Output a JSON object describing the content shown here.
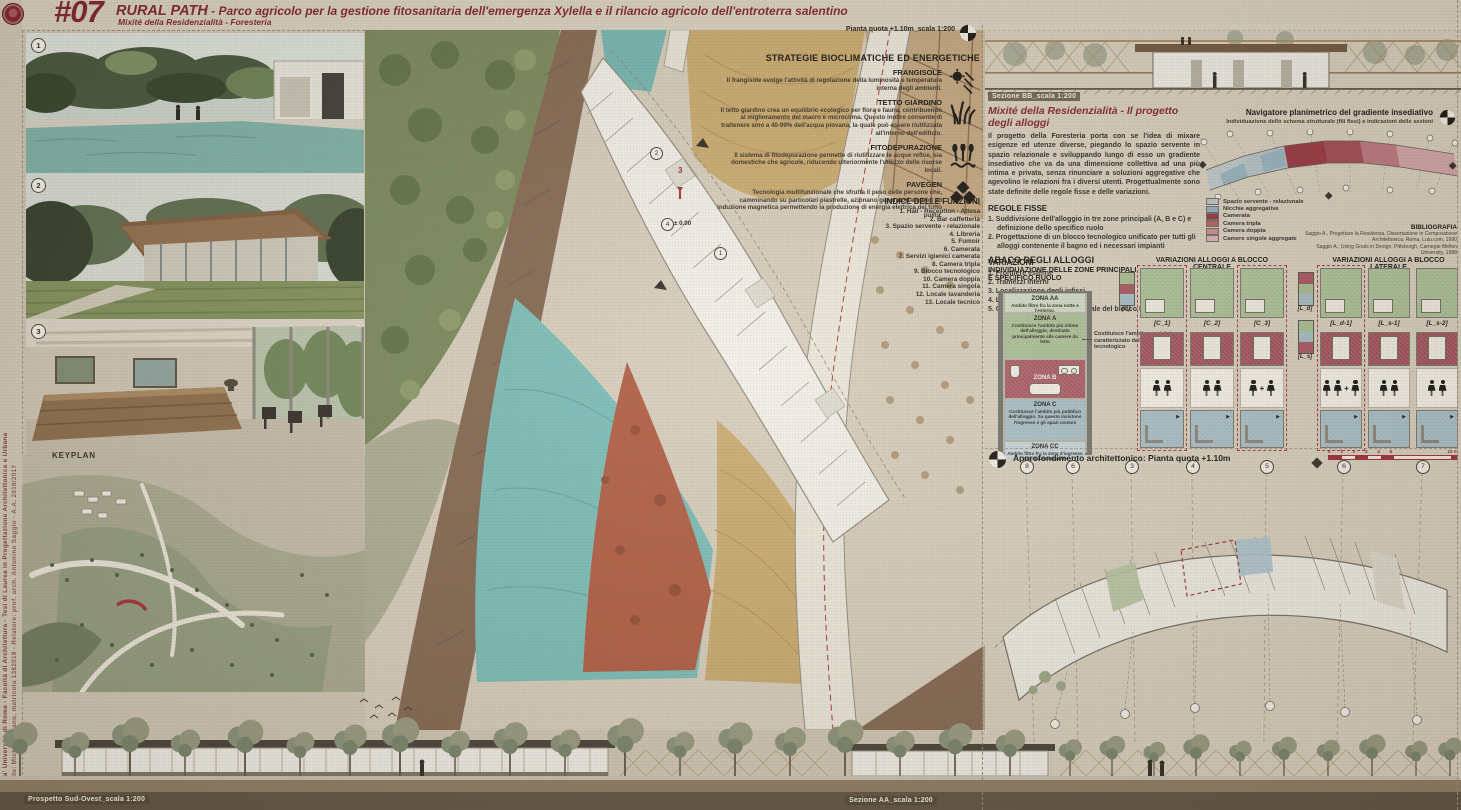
{
  "header": {
    "number": "#07",
    "title": "RURAL PATH",
    "subtitle": " - Parco agricolo per la gestione fitosanitaria dell'emergenza Xylella e il rilancio agricolo dell'entroterra salentino",
    "tagline": "Mixité della Residenzialità - Foresteria",
    "accent_color": "#7e1f2a",
    "logo": "sapienza-seal"
  },
  "side_caption": {
    "line1": "'Sapienza' Università di Roma - Facoltà di Architettura - Tesi di Laurea in Progettazione Architettonica e Urbana",
    "line2": "Laureando: Michele Spano, matricola 1382019 - Relatore: prof. arch. Antonino Saggio - A.A. 2016/2017"
  },
  "photos": {
    "badge1": "1",
    "badge2": "2",
    "badge3": "3"
  },
  "keyplan_label": "KEYPLAN",
  "masterplan": {
    "plan_scale_label": "Pianta quota +1.10m_scala 1:200",
    "level_marker": "± 0.00",
    "section_number": "3",
    "marker_2": "2",
    "marker_4": "4",
    "marker_1": "1"
  },
  "strategie": {
    "title": "STRATEGIE BIOCLIMATICHE ED ENERGETICHE",
    "items": [
      {
        "name": "FRANGISOLE",
        "icon": "sun-louvers-icon",
        "text": "Il frangisole svolge l'attività di regolazione della luminosità e temperatura interna degli ambienti."
      },
      {
        "name": "TETTO GIARDINO",
        "icon": "grass-icon",
        "text": "Il tetto giardino crea un equilibrio ecologico per flora e fauna, contribuendo al miglioramento del macro e microclima. Questo inoltre consente di trattenere sino a 40-99% dell'acqua piovana, la quale può essere riutilizzata all'interno dell'edificio."
      },
      {
        "name": "FITODEPURAZIONE",
        "icon": "reeds-water-icon",
        "text": "Il sistema di fitodepurazione permette di riutilizzare le acque reflue, sia domestiche che agricole, riducendo ulteriormente l'utilizzo delle risorse locali."
      },
      {
        "name": "PAVEGEN",
        "icon": "tiles-icon",
        "text": "Tecnologia multifunzionale che sfrutta il peso delle persone che, camminando su particolari piastrelle, azionano generatori elettrici ad induzione magnetica permettendo la produzione di energia elettrica del tutto pulita."
      }
    ]
  },
  "indice": {
    "title": "INDICE DELLE FUNZIONI",
    "items": [
      "1. Hall - Reception - Attesa",
      "2. Bar caffetteria",
      "3. Spazio servente - relazionale",
      "4. Libreria",
      "5. Fumoir",
      "6. Camerata",
      "7. Servizi igienici camerata",
      "8. Camera tripla",
      "9. Blocco tecnologico",
      "10. Camera doppia",
      "11. Camera singola",
      "12. Locale lavanderia",
      "13. Locale tecnico"
    ]
  },
  "bottom": {
    "prospetto_label": "Prospetto Sud-Ovest_scala 1:200",
    "sezione_aa_label": "Sezione AA_scala 1:200"
  },
  "right": {
    "sezione_bb_label": "Sezione BB_scala 1:200",
    "mixite": {
      "title": "Mixité della Residenzialità - Il progetto degli alloggi",
      "body": "Il progetto della Foresteria porta con se l'idea di mixare esigenze ed utenze diverse, piegando lo spazio servente in spazio relazionale e sviluppando lungo di esso un gradiente insediativo che va da una dimensione collettiva ad una più intima e privata, senza rinunciare a soluzioni aggregative che agevolino le relazioni fra i diversi utenti. Progettualmente sono state definite delle regole fisse e delle variazioni.",
      "regole_title": "REGOLE FISSE",
      "regole": [
        "1. Suddivisione dell'alloggio in tre zone principali (A, B e C) e definizione dello specifico ruolo",
        "2. Progettazione di un blocco tecnologico unificato per tutti gli alloggi contenente il bagno ed i necessari impianti"
      ],
      "variazioni_title": "VARIAZIONI",
      "variazioni": [
        "1. Frontiere esterne",
        "2. Tramezzi interni",
        "3. Localizzazione degli infissi",
        "4. Localizzazione degli arredi",
        "5. Collocazione centrale o laterale del blocco tecnologico"
      ]
    },
    "navigatore": {
      "title": "Navigatore planimetrico del gradiente insediativo",
      "subtitle": "Individuazione dello schema strutturale (fili fissi) e indicazioni delle sezioni",
      "legend": [
        {
          "label": "Spazio servente - relazionale",
          "color": "#b9c5c9"
        },
        {
          "label": "Nicchie aggregative",
          "color": "#8fafc0"
        },
        {
          "label": "Camerata",
          "color": "#8e323e"
        },
        {
          "label": "Camera tripla",
          "color": "#b05c66"
        },
        {
          "label": "Camera doppia",
          "color": "#c68d95"
        },
        {
          "label": "Camere singole aggregate",
          "color": "#d9b0b5"
        }
      ],
      "bibliografia_title": "BIBLIOGRAFIA",
      "bibliografia": [
        "Saggio A., Progettare la Residenza, Dissertazione in Composizione Architettonica, Roma, Lulu.com, 1990",
        "Saggio A., Using Goals in Design, Pittsburgh, Carnegie Mellon University, 1988"
      ]
    },
    "abaco": {
      "title": "ABACO DEGLI ALLOGGI",
      "subtitle": "INDIVIDUAZIONE DELLE ZONE PRINCIPALI E SPECIFICO RUOLO",
      "zones": [
        {
          "name": "ZONA AA",
          "text": "Ambito filtro fra la zona notte e l'esterno.",
          "color": "#ccd7c3"
        },
        {
          "name": "ZONA A",
          "text": "Costituisce l'ambito più intimo dell'alloggio, destinato principalmente alle camere da letto",
          "color": "#a6bd92"
        },
        {
          "name": "ZONA B",
          "text": "",
          "color": "#a65560"
        },
        {
          "name": "ZONA C",
          "text": "Costituisce l'ambito più pubblico dell'alloggio. Su questo insistono l'ingresso e gli spazi comuni",
          "color": "#a3bcc7"
        },
        {
          "name": "ZONA CC",
          "text": "Ambito filtro fra la zona d'ingresso e lo spazio servente",
          "color": "#c4d3d9"
        }
      ],
      "zona_b_note": "Costituisce l'ambito servizi, è caratterizzato dal modulo tecnologico",
      "centrale": {
        "title": "VARIAZIONI ALLOGGI A BLOCCO CENTRALE",
        "icon_label": "[C]",
        "variants": [
          "[C_1]",
          "[C_2]",
          "[C_3]"
        ],
        "occupants": [
          "2",
          "2",
          "1+1"
        ]
      },
      "laterale": {
        "title": "VARIAZIONI ALLOGGI A BLOCCO LATERALE",
        "icon_labels": [
          "[L_d]",
          "[L_s]"
        ],
        "variants": [
          "[L_d-1]",
          "[L_s-1]",
          "[L_s-2]"
        ],
        "occupants": [
          "2+1",
          "2",
          "2"
        ]
      }
    },
    "approfondimento": {
      "title": "Approfondimento architettonico: Pianta quota +1.10m",
      "grid_numbers": [
        "8",
        "6",
        "3",
        "4",
        "5",
        "6",
        "7"
      ],
      "scale_left": "0 1 2 3 4 5",
      "scale_right": "10 m"
    }
  }
}
